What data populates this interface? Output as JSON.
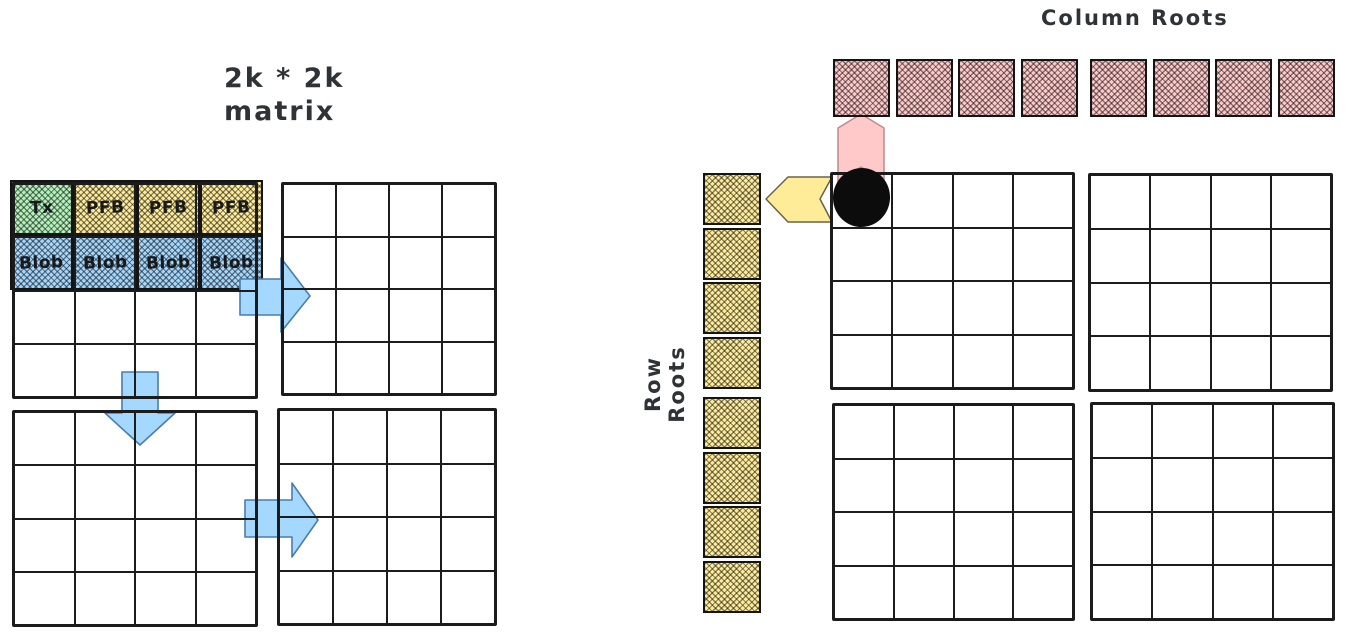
{
  "diagram": {
    "matrix_caption": {
      "line1": "2k * 2k",
      "line2": "matrix"
    },
    "column_roots_label": "Column Roots",
    "row_roots_label": "Row Roots"
  },
  "matrix_blocks": {
    "rows_per_grid": 4,
    "cols_per_grid": 4,
    "left_quadrants": 4,
    "right_quadrants": 4,
    "header_cells": [
      {
        "label": "Tx",
        "fill": "#b2f2bb"
      },
      {
        "label": "PFB",
        "fill": "#ffec99"
      },
      {
        "label": "PFB",
        "fill": "#ffec99"
      },
      {
        "label": "PFB",
        "fill": "#ffec99"
      }
    ],
    "blob_cells": [
      {
        "label": "Blob",
        "fill": "#a5d8ff"
      },
      {
        "label": "Blob",
        "fill": "#a5d8ff"
      },
      {
        "label": "Blob",
        "fill": "#a5d8ff"
      },
      {
        "label": "Blob",
        "fill": "#a5d8ff"
      }
    ]
  },
  "column_roots": {
    "count": 8,
    "groups": 2,
    "fill": "#ffc9c9"
  },
  "row_roots": {
    "count": 8,
    "groups": 2,
    "fill": "#ffec99"
  },
  "colors": {
    "arrow_blue": "#a5d8ff",
    "arrow_pink": "#ffc9c9",
    "arrow_yellow": "#ffec99",
    "ink": "#1b1b1b",
    "text": "#2e3338"
  }
}
